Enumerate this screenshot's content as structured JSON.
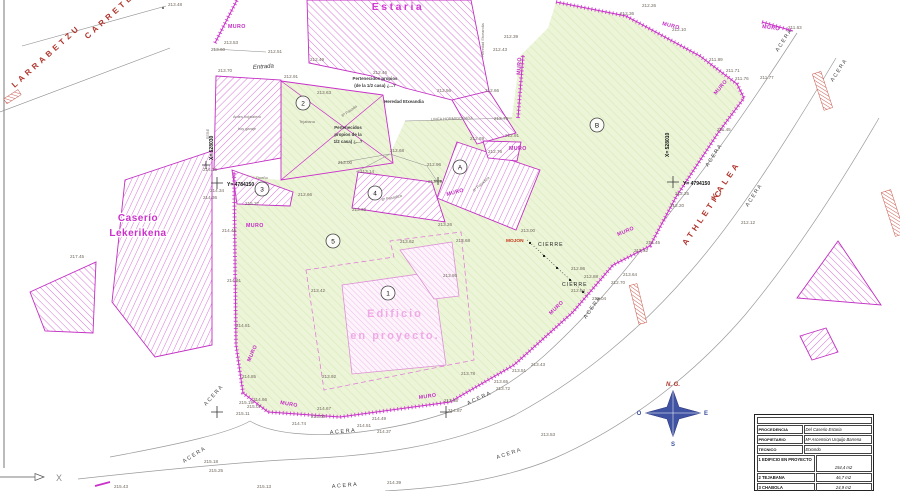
{
  "axis": {
    "x_label": "X"
  },
  "compass": {
    "north": "N. G.",
    "west": "O",
    "east": "E",
    "south": "S"
  },
  "colors": {
    "magenta": "#c92fc9",
    "green_fill": "#edf5d9",
    "road_red": "#b0342c",
    "compass_blue": "#3b4fa0"
  },
  "labels": {
    "spot": [
      [
        168,
        6,
        "213.48"
      ],
      [
        224,
        44,
        "213.53"
      ],
      [
        211,
        51,
        "213.60"
      ],
      [
        268,
        53,
        "212.51"
      ],
      [
        218,
        72,
        "213.70"
      ],
      [
        284,
        78,
        "212.91"
      ],
      [
        310,
        61,
        "212.49"
      ],
      [
        373,
        74,
        "212.46"
      ],
      [
        317,
        94,
        "213.63"
      ],
      [
        493,
        51,
        "212.43"
      ],
      [
        504,
        38,
        "212.39"
      ],
      [
        437,
        92,
        "212.56"
      ],
      [
        485,
        92,
        "212.66"
      ],
      [
        494,
        120,
        "212.75"
      ],
      [
        470,
        140,
        "212.69"
      ],
      [
        505,
        137,
        "212.91"
      ],
      [
        390,
        152,
        "212.68"
      ],
      [
        427,
        166,
        "212.96"
      ],
      [
        360,
        173,
        "213.14"
      ],
      [
        488,
        153,
        "212.76"
      ],
      [
        428,
        183,
        "213.19"
      ],
      [
        338,
        164,
        "213.00"
      ],
      [
        352,
        211,
        "213.32"
      ],
      [
        438,
        226,
        "213.26"
      ],
      [
        298,
        196,
        "212.66"
      ],
      [
        245,
        205,
        "215.27"
      ],
      [
        203,
        171,
        "214.15"
      ],
      [
        210,
        192,
        "214.34"
      ],
      [
        203,
        199,
        "214.36"
      ],
      [
        70,
        258,
        "217.45"
      ],
      [
        222,
        232,
        "214.46"
      ],
      [
        227,
        282,
        "214.61"
      ],
      [
        236,
        327,
        "214.81"
      ],
      [
        311,
        292,
        "213.42"
      ],
      [
        400,
        243,
        "213.62"
      ],
      [
        456,
        242,
        "213.68"
      ],
      [
        443,
        277,
        "213.95"
      ],
      [
        322,
        378,
        "213.92"
      ],
      [
        461,
        375,
        "213.78"
      ],
      [
        521,
        232,
        "213.00"
      ],
      [
        571,
        270,
        "212.86"
      ],
      [
        584,
        278,
        "212.88"
      ],
      [
        571,
        292,
        "212.94"
      ],
      [
        592,
        300,
        "213.04"
      ],
      [
        646,
        244,
        "212.45"
      ],
      [
        634,
        252,
        "212.52"
      ],
      [
        623,
        276,
        "213.64"
      ],
      [
        611,
        284,
        "212.70"
      ],
      [
        642,
        7,
        "212.26"
      ],
      [
        620,
        15,
        "212.36"
      ],
      [
        672,
        31,
        "212.10"
      ],
      [
        709,
        61,
        "211.89"
      ],
      [
        726,
        72,
        "211.71"
      ],
      [
        735,
        80,
        "211.76"
      ],
      [
        760,
        79,
        "211.77"
      ],
      [
        788,
        29,
        "211.63"
      ],
      [
        717,
        131,
        "211.45"
      ],
      [
        675,
        195,
        "212.25"
      ],
      [
        670,
        207,
        "212.20"
      ],
      [
        741,
        224,
        "212.12"
      ],
      [
        531,
        366,
        "213.43"
      ],
      [
        512,
        372,
        "213.51"
      ],
      [
        494,
        383,
        "213.65"
      ],
      [
        496,
        390,
        "213.72"
      ],
      [
        444,
        402,
        "213.85"
      ],
      [
        448,
        412,
        "214.87"
      ],
      [
        242,
        378,
        "214.85"
      ],
      [
        239,
        404,
        "215.19"
      ],
      [
        253,
        401,
        "214.66"
      ],
      [
        247,
        408,
        "215.07"
      ],
      [
        236,
        415,
        "215.11"
      ],
      [
        317,
        410,
        "214.67"
      ],
      [
        311,
        418,
        "214.05"
      ],
      [
        292,
        425,
        "214.74"
      ],
      [
        372,
        420,
        "214.49"
      ],
      [
        357,
        427,
        "214.51"
      ],
      [
        377,
        433,
        "214.37"
      ],
      [
        541,
        436,
        "213.53"
      ],
      [
        387,
        484,
        "214.39"
      ],
      [
        257,
        488,
        "215.13"
      ],
      [
        204,
        463,
        "215.18"
      ],
      [
        209,
        472,
        "215.25"
      ],
      [
        114,
        488,
        "215.43"
      ]
    ],
    "muro": [
      [
        228,
        28,
        "MURO",
        0
      ],
      [
        662,
        25,
        "MURO",
        14
      ],
      [
        762,
        28,
        "MURO",
        8
      ],
      [
        716,
        95,
        "MURO",
        -50
      ],
      [
        520,
        75,
        "MURO",
        -86
      ],
      [
        509,
        150,
        "MURO",
        0
      ],
      [
        447,
        196,
        "MURO",
        -15
      ],
      [
        246,
        227,
        "MURO",
        0
      ],
      [
        618,
        236,
        "MURO",
        -22
      ],
      [
        551,
        315,
        "MURO",
        -44
      ],
      [
        280,
        404,
        "MURO",
        10
      ],
      [
        250,
        362,
        "MURO",
        -66
      ],
      [
        419,
        399,
        "MURO",
        -8
      ]
    ],
    "mojon": [
      [
        506,
        242,
        "MOJON",
        0
      ]
    ],
    "cierre": [
      [
        538,
        246,
        "CIERRE",
        0
      ],
      [
        562,
        286,
        "CIERRE",
        0
      ]
    ],
    "acera": [
      [
        778,
        52,
        "ACERA",
        -57
      ],
      [
        833,
        82,
        "ACERA",
        -57
      ],
      [
        708,
        167,
        "ACERA",
        -57
      ],
      [
        748,
        207,
        "ACERA",
        -57
      ],
      [
        586,
        319,
        "ACERA",
        -55
      ],
      [
        468,
        405,
        "ACERA",
        -25
      ],
      [
        330,
        434,
        "ACERA",
        -5
      ],
      [
        332,
        488,
        "ACERA",
        -5
      ],
      [
        206,
        406,
        "ACERA",
        -48
      ],
      [
        184,
        463,
        "ACERA",
        -32
      ],
      [
        497,
        459,
        "ACERA",
        -18
      ]
    ],
    "road": [
      [
        48,
        58,
        "LARRABETZU",
        -42
      ],
      [
        118,
        12,
        "CARRETERA",
        -42
      ],
      [
        705,
        218,
        "ATHLETIC",
        -56
      ],
      [
        728,
        182,
        "KALEA",
        -56
      ]
    ],
    "estaria": [
      [
        398,
        10,
        "Estaria",
        0
      ]
    ],
    "caserio": [
      [
        138,
        221,
        "Caserío",
        0
      ],
      [
        138,
        236,
        "Lekerikena",
        0
      ]
    ],
    "edificio": [
      [
        395,
        317,
        "Edificio",
        0
      ],
      [
        395,
        339,
        "en proyecto.",
        0
      ]
    ],
    "small": [
      [
        375,
        80,
        "Pertenecidos propios",
        0
      ],
      [
        375,
        87,
        "(de la 1/2 casa) ¿...?",
        0
      ],
      [
        348,
        129,
        "Pertenecidos",
        0
      ],
      [
        348,
        136,
        "propios de la",
        0
      ],
      [
        348,
        143,
        "1/2 casa) ¿...?",
        0
      ],
      [
        404,
        103,
        "Heredad Etxeandia",
        0
      ]
    ],
    "tiny": [
      [
        247,
        118,
        "Antes hojalatero",
        0
      ],
      [
        247,
        130,
        "hoy garaje",
        0
      ],
      [
        307,
        123,
        "Tejabana",
        0
      ],
      [
        350,
        112,
        "8ª Pasada",
        -35
      ],
      [
        392,
        199,
        "8ª Pasadiza",
        -12
      ],
      [
        482,
        185,
        "8ª Pasadiza",
        -42
      ],
      [
        262,
        179,
        "Dueño",
        0
      ],
      [
        209,
        134,
        "SEBE",
        -90
      ],
      [
        452,
        120,
        "LINEA HORMIGONADA",
        -2
      ],
      [
        484,
        40,
        "Heredad Etxeandia",
        -90
      ]
    ],
    "entrada": [
      [
        253,
        69,
        "Entrada",
        -4
      ]
    ],
    "coord": [
      [
        227,
        186,
        "Y= 4784150",
        0
      ],
      [
        683,
        185,
        "Y= 4794150",
        0
      ],
      [
        213,
        160,
        "X= 528030",
        -90
      ],
      [
        669,
        157,
        "X= 528010",
        -90
      ]
    ]
  },
  "markers": {
    "circles": [
      [
        388,
        293,
        "1"
      ],
      [
        303,
        103,
        "2"
      ],
      [
        262,
        189,
        "3"
      ],
      [
        375,
        193,
        "4"
      ],
      [
        333,
        241,
        "5"
      ],
      [
        460,
        167,
        "A"
      ],
      [
        597,
        125,
        "B"
      ]
    ],
    "crosses": [
      [
        217,
        183,
        6
      ],
      [
        673,
        182,
        6
      ],
      [
        217,
        412,
        6
      ],
      [
        446,
        412,
        6
      ],
      [
        206,
        165,
        4
      ],
      [
        438,
        181,
        4
      ]
    ],
    "cierre_dots": [
      [
        530,
        243
      ],
      [
        544,
        256
      ],
      [
        557,
        268
      ],
      [
        570,
        280
      ],
      [
        583,
        292
      ]
    ]
  },
  "title_block": {
    "rows": [
      {
        "label": "PROCEDENCIA",
        "value": "Del Caserio Estaria"
      },
      {
        "label": "PROPIETARIO",
        "value": "Mª Ascension Urquijo Barrena"
      },
      {
        "label": "TECNICO",
        "value": "Etxondo"
      }
    ],
    "items": [
      {
        "num": "1",
        "label": "EDIFICIO EN PROYECTO",
        "value": "154,4 m2"
      },
      {
        "num": "2",
        "label": "TEJABANA",
        "value": "46,7 m2"
      },
      {
        "num": "3",
        "label": "CHABOLA",
        "value": "24,9 m2"
      }
    ]
  }
}
